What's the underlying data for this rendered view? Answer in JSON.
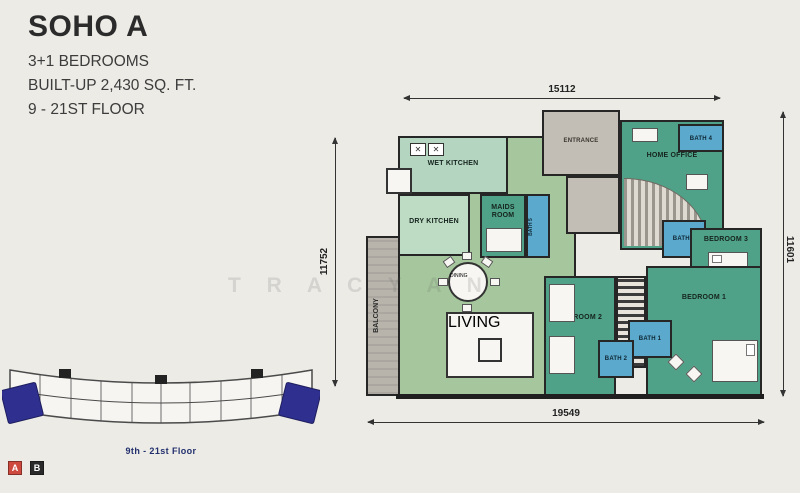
{
  "title_block": {
    "name": "SOHO A",
    "bedrooms": "3+1 BEDROOMS",
    "built_up": "BUILT-UP 2,430 SQ. FT.",
    "floors": "9 - 21ST FLOOR"
  },
  "dimensions": {
    "top": "15112",
    "left": "11752",
    "right": "11601",
    "bottom": "19549"
  },
  "rooms": {
    "wet_kitchen": "WET KITCHEN",
    "dry_kitchen": "DRY KITCHEN",
    "maids_room": "MAIDS ROOM",
    "bath5": "BATH 5",
    "entrance": "ENTRANCE",
    "home_office": "HOME OFFICE",
    "bath4": "BATH 4",
    "bath3": "BATH 3",
    "bedroom3": "BEDROOM 3",
    "bedroom2": "BEDROOM 2",
    "bedroom1": "BEDROOM 1",
    "bath1": "BATH 1",
    "bath2": "BATH 2",
    "dining": "DINING",
    "living": "LIVING",
    "balcony": "BALCONY"
  },
  "key_plan": {
    "caption": "9th - 21st Floor",
    "legend_a": "A",
    "legend_b": "B"
  },
  "watermark": "T R A C Y    A N",
  "colors": {
    "background": "#ecebe6",
    "bedroom_green": "#4fa287",
    "living_green": "#a6c79d",
    "kitchen_green": "#b4d6c0",
    "bath_blue": "#5ba9cd",
    "gray_area": "#c2beb6",
    "wall": "#1f1f1f",
    "highlight_unit_navy": "#2f2f8f",
    "legend_a_red": "#cf4a3e",
    "legend_b_black": "#2a2a2a"
  }
}
